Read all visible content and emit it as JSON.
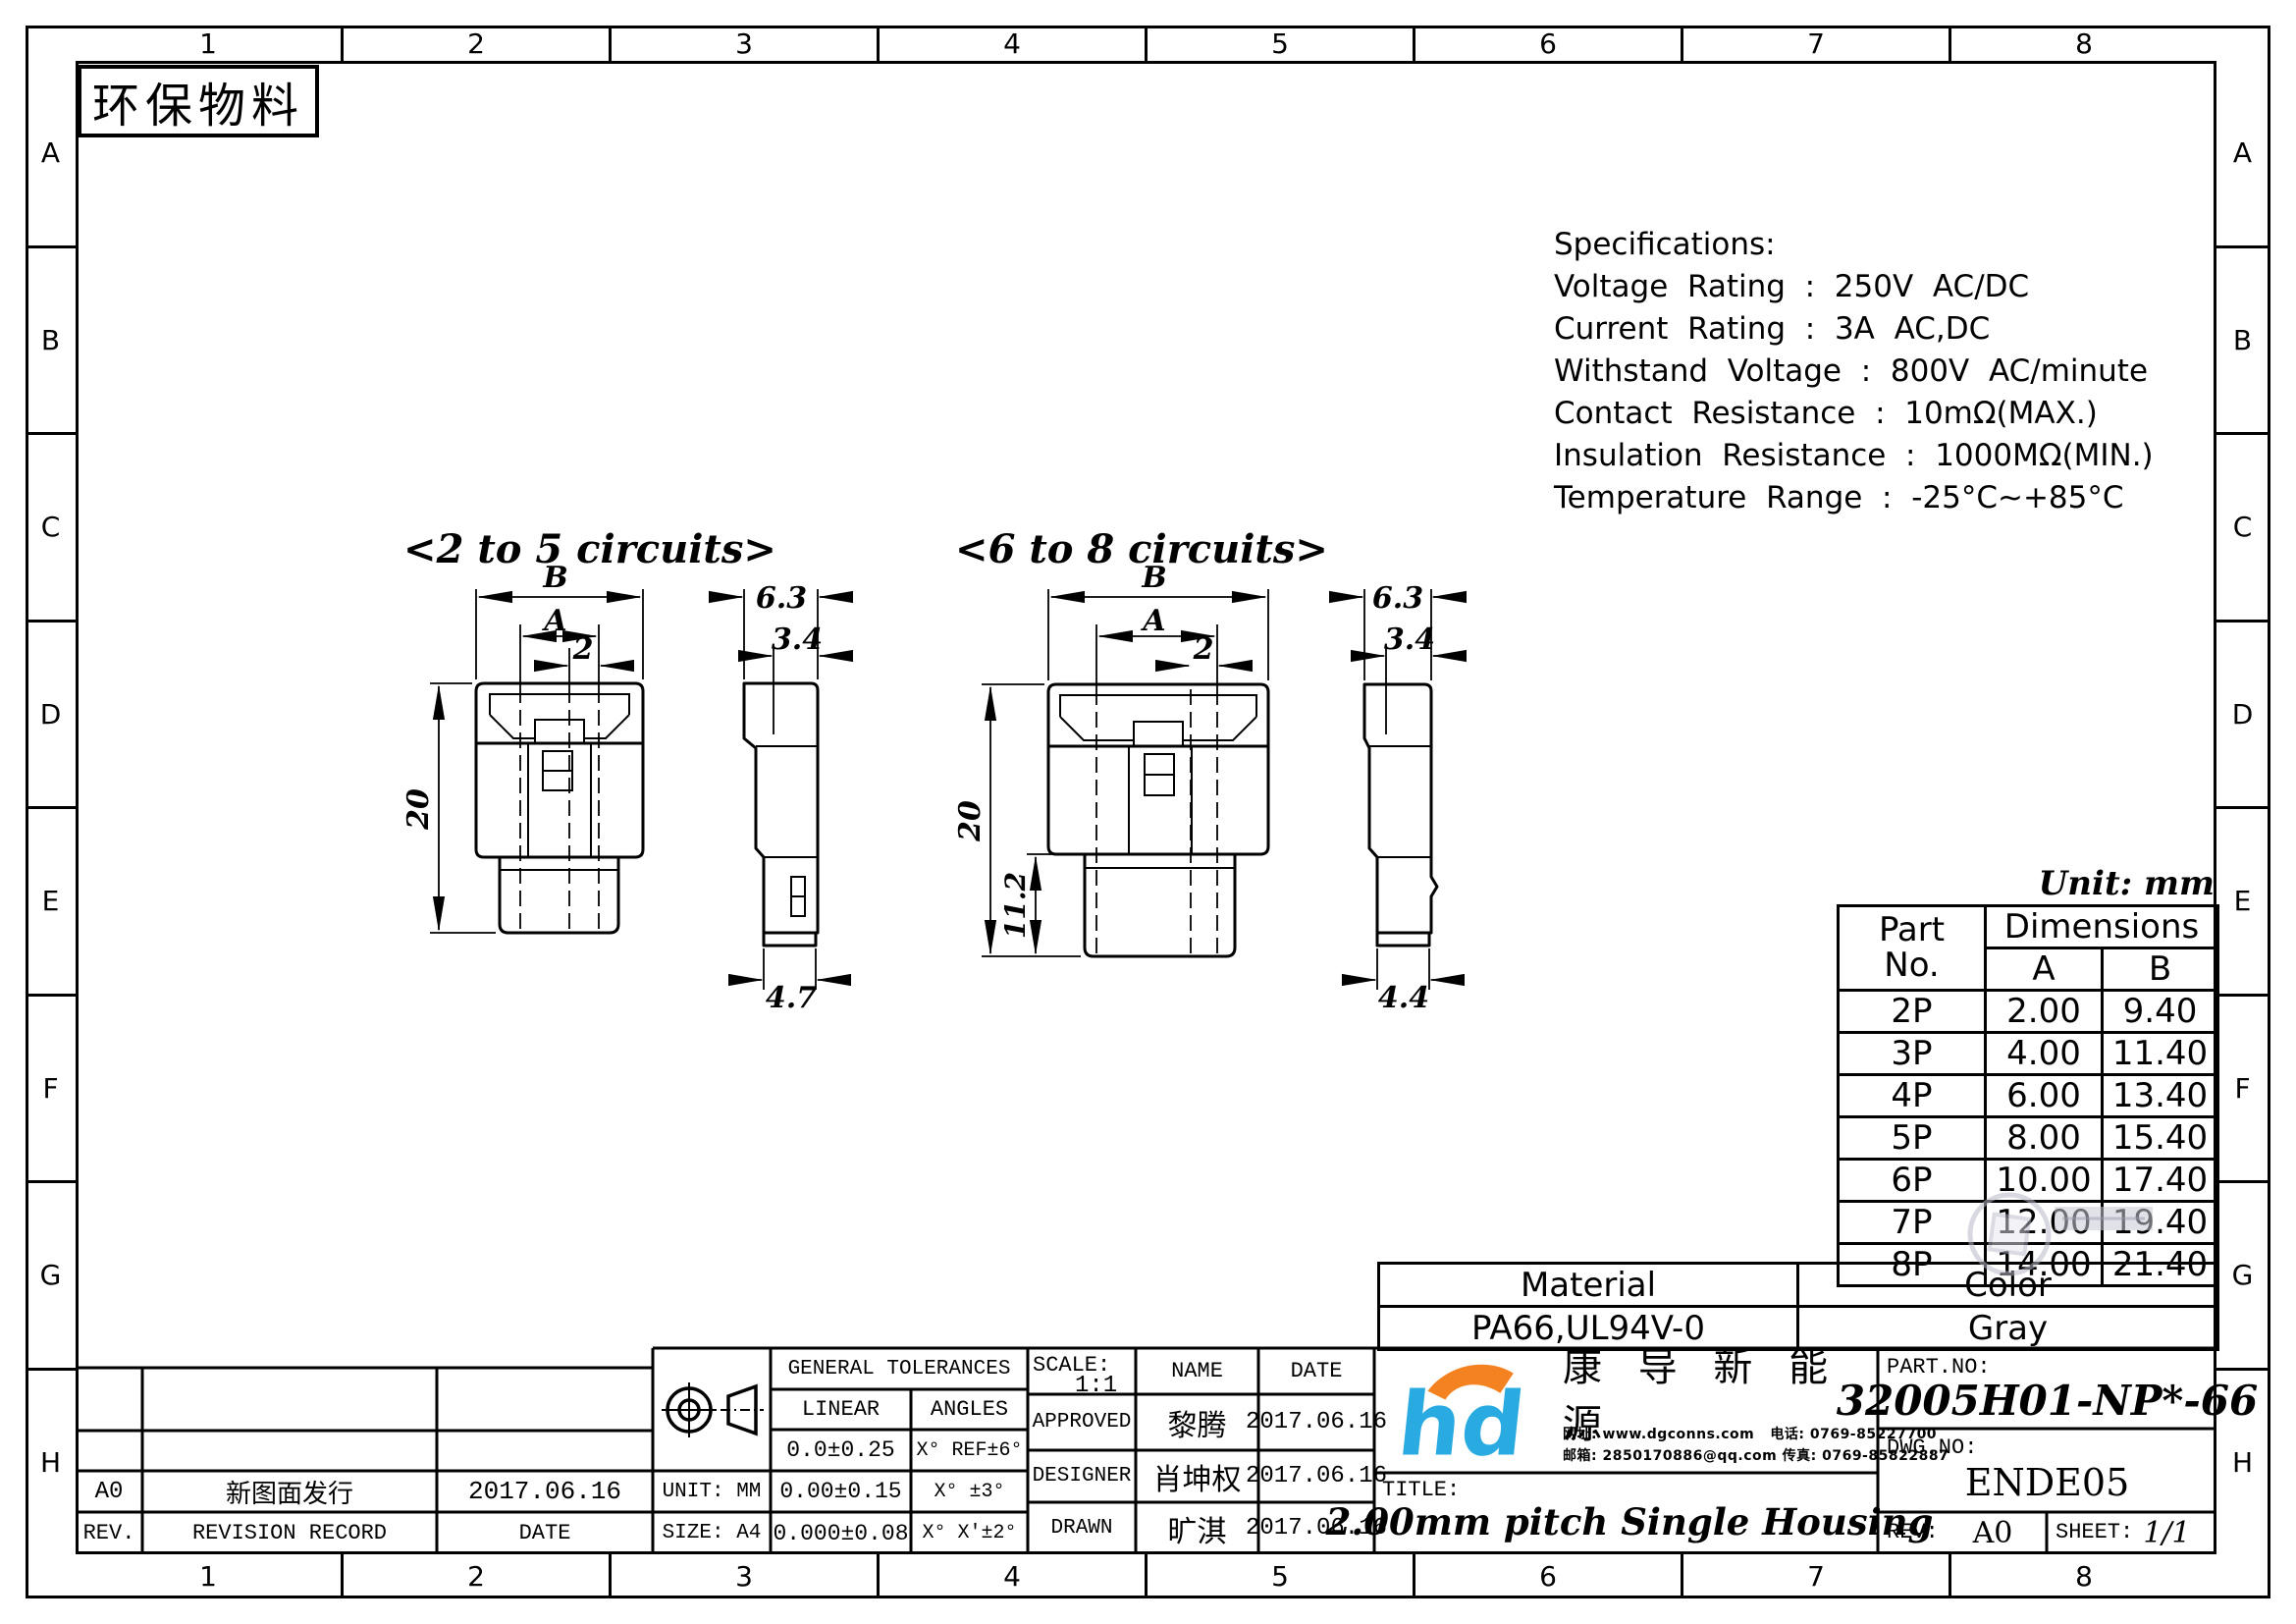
{
  "eco_label": "环保物料",
  "unit_note": "Unit: mm",
  "border": {
    "columns": [
      "1",
      "2",
      "3",
      "4",
      "5",
      "6",
      "7",
      "8"
    ],
    "rows": [
      "A",
      "B",
      "C",
      "D",
      "E",
      "F",
      "G",
      "H"
    ]
  },
  "specifications": {
    "title": "Specifications:",
    "lines": [
      "Voltage  Rating  :  250V  AC/DC",
      "Current  Rating  :  3A  AC,DC",
      "Withstand  Voltage  :  800V  AC/minute",
      "Contact  Resistance  :  10mΩ(MAX.)",
      "Insulation  Resistance  :  1000MΩ(MIN.)",
      "Temperature  Range  :  -25°C~+85°C"
    ]
  },
  "views": {
    "view_a": {
      "title": "<2 to 5 circuits>",
      "dim_b": "B",
      "dim_a": "A",
      "dim_pitch": "2",
      "dim_height": "20",
      "side_top": "6.3",
      "side_inner": "3.4",
      "side_bottom": "4.7"
    },
    "view_b": {
      "title": "<6 to 8 circuits>",
      "dim_b": "B",
      "dim_a": "A",
      "dim_pitch": "2",
      "dim_height": "20",
      "dim_pocket": "11.2",
      "side_top": "6.3",
      "side_inner": "3.4",
      "side_bottom": "4.4"
    }
  },
  "parts_table": {
    "header_part_1": "Part",
    "header_part_2": "No.",
    "header_dimensions": "Dimensions",
    "header_a": "A",
    "header_b": "B",
    "rows": [
      {
        "part": "2P",
        "a": "2.00",
        "b": "9.40"
      },
      {
        "part": "3P",
        "a": "4.00",
        "b": "11.40"
      },
      {
        "part": "4P",
        "a": "6.00",
        "b": "13.40"
      },
      {
        "part": "5P",
        "a": "8.00",
        "b": "15.40"
      },
      {
        "part": "6P",
        "a": "10.00",
        "b": "17.40"
      },
      {
        "part": "7P",
        "a": "12.00",
        "b": "19.40"
      },
      {
        "part": "8P",
        "a": "14.00",
        "b": "21.40"
      }
    ]
  },
  "material_table": {
    "material_label": "Material",
    "color_label": "Color",
    "material_value": "PA66,UL94V-0",
    "color_value": "Gray"
  },
  "revision_table": {
    "header": {
      "rev": "REV.",
      "record": "REVISION RECORD",
      "date": "DATE"
    },
    "rows": [
      {
        "rev": "A0",
        "record": "新图面发行",
        "date": "2017.06.16"
      }
    ]
  },
  "format_info": {
    "unit": "UNIT: MM",
    "size": "SIZE: A4"
  },
  "tolerances": {
    "title": "GENERAL TOLERANCES",
    "linear_label": "LINEAR",
    "angles_label": "ANGLES",
    "rows": [
      {
        "linear": "0.0±0.25",
        "angles": "X° REF±6°"
      },
      {
        "linear": "0.00±0.15",
        "angles": "X° ±3°"
      },
      {
        "linear": "0.000±0.08",
        "angles": "X° X'±2°"
      }
    ]
  },
  "approval": {
    "scale_label": "SCALE:",
    "scale_value": "1:1",
    "name_label": "NAME",
    "date_label": "DATE",
    "rows": [
      {
        "role": "APPROVED",
        "name": "黎腾",
        "date": "2017.06.16"
      },
      {
        "role": "DESIGNER",
        "name": "肖坤权",
        "date": "2017.06.16"
      },
      {
        "role": "DRAWN",
        "name": "旷淇",
        "date": "2017.06.16"
      }
    ]
  },
  "company": {
    "name": "康 导 新 能 源",
    "contact_line1": "网址: www.dgconns.com   电话: 0769-85227700",
    "contact_line2": "邮箱: 2850170886@qq.com 传真: 0769-85822887",
    "logo_blue": "#29abe2",
    "logo_orange": "#f58220"
  },
  "title_block": {
    "title_label": "TITLE:",
    "title_value": "2.00mm pitch Single Housing",
    "part_no_label": "PART.NO:",
    "part_no_value": "32005H01-NP*-66",
    "dwg_no_label": "DWG.NO:",
    "dwg_no_value": "ENDE05",
    "rev_label": "REV:",
    "rev_value": "A0",
    "sheet_label": "SHEET:",
    "sheet_value": "1/1"
  }
}
